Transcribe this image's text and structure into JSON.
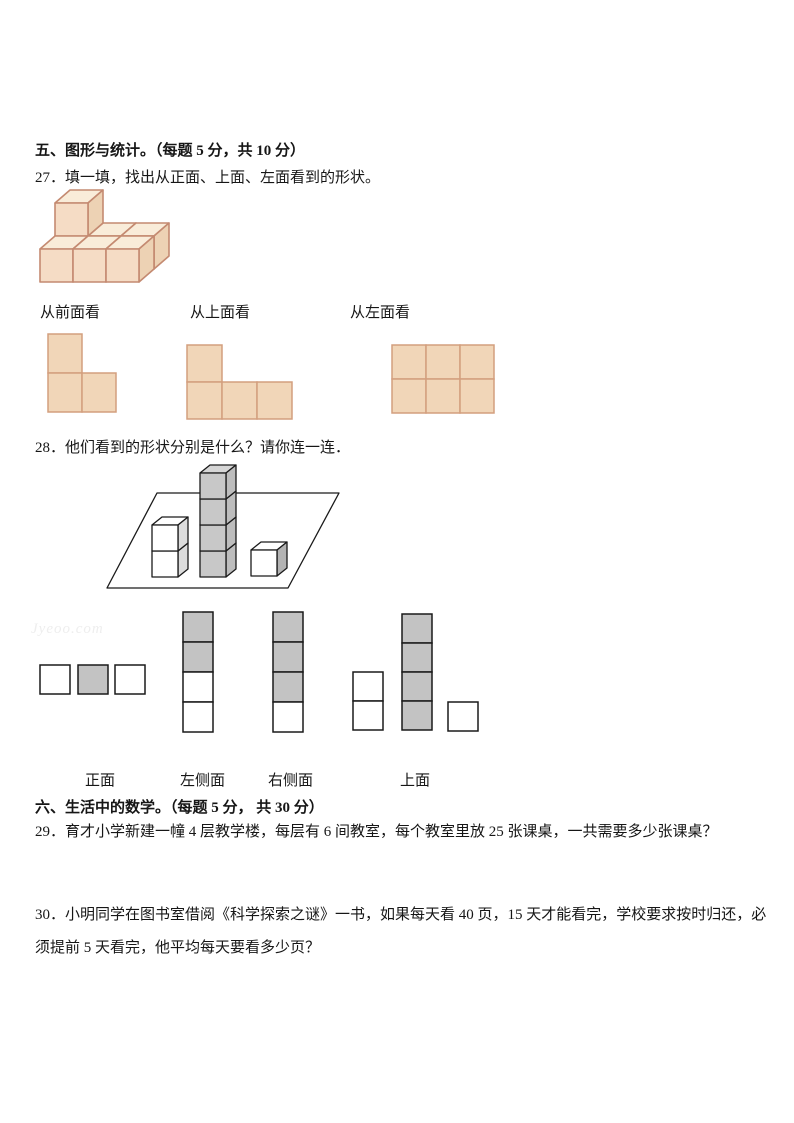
{
  "watermark": {
    "text": "Jyeoo.com"
  },
  "sections": {
    "five": {
      "heading": "五、图形与统计。（每题 5 分，共 10 分）"
    },
    "six": {
      "heading": "六、生活中的数学。（每题 5 分， 共 30 分）"
    }
  },
  "q27": {
    "text": "27．填一填，找出从正面、上面、左面看到的形状。",
    "view_labels": [
      "从前面看",
      "从上面看",
      "从左面看"
    ]
  },
  "q28": {
    "text": "28．他们看到的形状分别是什么？请你连一连．",
    "option_labels": [
      "正面",
      "左侧面",
      "右侧面",
      "上面"
    ]
  },
  "q29": {
    "text": "29．育才小学新建一幢 4 层教学楼，每层有 6 间教室，每个教室里放 25 张课桌，一共需要多少张课桌？"
  },
  "q30": {
    "text": "30．小明同学在图书室借阅《科学探索之谜》一书，如果每天看 40 页，15 天才能看完，学校要求按时归还，必须提前 5 天看完，他平均每天要看多少页？"
  },
  "colors": {
    "cube_front": "#f5dcc5",
    "cube_top": "#f9ecd9",
    "cube_right": "#edd2b4",
    "cube_edge": "#c48a71",
    "tan_square_fill": "#f1d6b8",
    "tan_square_edge": "#d39f7e",
    "gray_square_fill": "#c3c3c3",
    "line_black": "#1a1a1a"
  },
  "figures": {
    "q27_iso": {
      "name": "q27-cube-stack-figure",
      "origin": [
        40,
        282
      ],
      "size": 33,
      "depth": [
        15,
        -13
      ],
      "stroke": "#c48a71",
      "stroke_width": 1.6,
      "front": "#f5dcc5",
      "top": "#f9ecd9",
      "right": "#edd2b4",
      "cubes": [
        [
          0,
          1,
          0
        ],
        [
          1,
          1,
          0
        ],
        [
          2,
          1,
          0
        ],
        [
          0,
          1,
          1
        ],
        [
          0,
          0,
          0
        ],
        [
          1,
          0,
          0
        ],
        [
          2,
          0,
          0
        ]
      ]
    },
    "q28_scene": {
      "name": "q28-cubes-on-plane-figure",
      "plane": [
        [
          157,
          493
        ],
        [
          339,
          493
        ],
        [
          288,
          588
        ],
        [
          107,
          588
        ]
      ],
      "size": 26,
      "depth": [
        10,
        -8
      ],
      "stroke": "#1a1a1a",
      "stroke_width": 1.3,
      "stacks": [
        {
          "x": 152,
          "bottom": 577,
          "count": 2,
          "front": "#ffffff",
          "top": "#ffffff",
          "right": "#dcdcdc"
        },
        {
          "x": 200,
          "bottom": 577,
          "count": 4,
          "front": "#c8c8c8",
          "top": "#d6d6d6",
          "right": "#bdbdbd"
        },
        {
          "x": 251,
          "bottom": 576,
          "count": 1,
          "front": "#ffffff",
          "top": "#ffffff",
          "right": "#b3b3b3"
        }
      ]
    },
    "grids": [
      {
        "name": "q27-front-view-shape",
        "x": 48,
        "y": 334,
        "w": 34,
        "h": 39,
        "stroke": "#d39f7e",
        "sw": 1.5,
        "cells": [
          {
            "dx": 0,
            "dy": 0,
            "fill": "#f1d6b8"
          },
          {
            "dx": 0,
            "dy": 39,
            "fill": "#f1d6b8"
          },
          {
            "dx": 34,
            "dy": 39,
            "fill": "#f1d6b8"
          }
        ]
      },
      {
        "name": "q27-top-view-shape",
        "x": 187,
        "y": 345,
        "w": 35,
        "h": 37,
        "stroke": "#d39f7e",
        "sw": 1.5,
        "cells": [
          {
            "dx": 0,
            "dy": 0,
            "fill": "#f1d6b8"
          },
          {
            "dx": 0,
            "dy": 37,
            "fill": "#f1d6b8"
          },
          {
            "dx": 35,
            "dy": 37,
            "fill": "#f1d6b8"
          },
          {
            "dx": 70,
            "dy": 37,
            "fill": "#f1d6b8"
          }
        ]
      },
      {
        "name": "q27-left-view-shape",
        "x": 392,
        "y": 345,
        "w": 34,
        "h": 34,
        "stroke": "#d39f7e",
        "sw": 1.5,
        "cells": [
          {
            "dx": 0,
            "dy": 0,
            "fill": "#f1d6b8"
          },
          {
            "dx": 34,
            "dy": 0,
            "fill": "#f1d6b8"
          },
          {
            "dx": 68,
            "dy": 0,
            "fill": "#f1d6b8"
          },
          {
            "dx": 0,
            "dy": 34,
            "fill": "#f1d6b8"
          },
          {
            "dx": 34,
            "dy": 34,
            "fill": "#f1d6b8"
          },
          {
            "dx": 68,
            "dy": 34,
            "fill": "#f1d6b8"
          }
        ]
      },
      {
        "name": "q28-option-front-shape",
        "x": 40,
        "y": 665,
        "w": 30,
        "h": 29,
        "stroke": "#1a1a1a",
        "sw": 1.5,
        "cells": [
          {
            "dx": 0,
            "dy": 0,
            "fill": "#ffffff"
          },
          {
            "dx": 38,
            "dy": 0,
            "fill": "#c3c3c3"
          },
          {
            "dx": 75,
            "dy": 0,
            "fill": "#ffffff"
          }
        ]
      },
      {
        "name": "q28-option-left-side-shape",
        "x": 183,
        "y": 612,
        "w": 30,
        "h": 30,
        "stroke": "#1a1a1a",
        "sw": 1.5,
        "cells": [
          {
            "dx": 0,
            "dy": 0,
            "fill": "#c3c3c3"
          },
          {
            "dx": 0,
            "dy": 30,
            "fill": "#c3c3c3"
          },
          {
            "dx": 0,
            "dy": 60,
            "fill": "#ffffff"
          },
          {
            "dx": 0,
            "dy": 90,
            "fill": "#ffffff"
          }
        ]
      },
      {
        "name": "q28-option-right-side-shape",
        "x": 273,
        "y": 612,
        "w": 30,
        "h": 30,
        "stroke": "#1a1a1a",
        "sw": 1.5,
        "cells": [
          {
            "dx": 0,
            "dy": 0,
            "fill": "#c3c3c3"
          },
          {
            "dx": 0,
            "dy": 30,
            "fill": "#c3c3c3"
          },
          {
            "dx": 0,
            "dy": 60,
            "fill": "#c3c3c3"
          },
          {
            "dx": 0,
            "dy": 90,
            "fill": "#ffffff"
          }
        ]
      },
      {
        "name": "q28-option-top-shape",
        "x": 353,
        "y": 614,
        "w": 30,
        "h": 29,
        "stroke": "#1a1a1a",
        "sw": 1.5,
        "cells": [
          {
            "dx": 0,
            "dy": 58,
            "fill": "#ffffff"
          },
          {
            "dx": 0,
            "dy": 87,
            "fill": "#ffffff"
          },
          {
            "dx": 49,
            "dy": 0,
            "fill": "#c3c3c3"
          },
          {
            "dx": 49,
            "dy": 29,
            "fill": "#c3c3c3"
          },
          {
            "dx": 49,
            "dy": 58,
            "fill": "#c3c3c3"
          },
          {
            "dx": 49,
            "dy": 87,
            "fill": "#c3c3c3"
          },
          {
            "dx": 95,
            "dy": 88,
            "fill": "#ffffff"
          }
        ]
      }
    ]
  }
}
